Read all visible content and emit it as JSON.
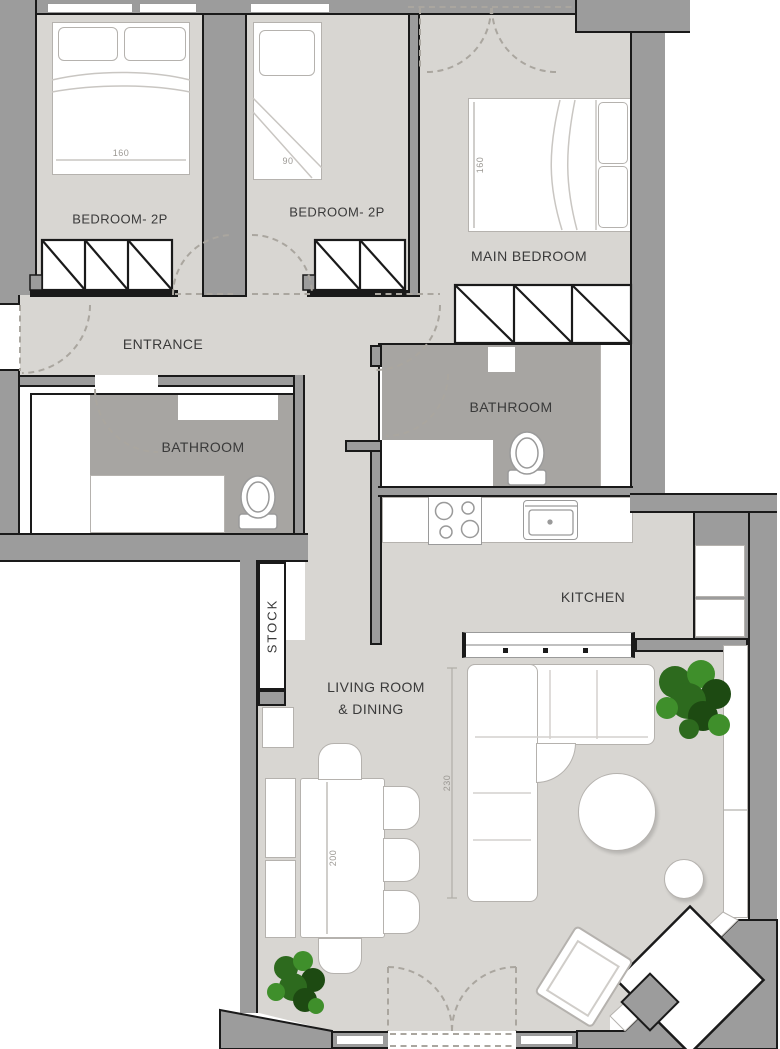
{
  "title": "Apartment floor plan",
  "rooms": {
    "bedroom1": {
      "label": "BEDROOM- 2P",
      "bed_dim": "160"
    },
    "bedroom2": {
      "label": "BEDROOM- 2P",
      "bed_dim": "90"
    },
    "main_bedroom": {
      "label": "MAIN BEDROOM",
      "bed_dim": "160"
    },
    "entrance": {
      "label": "ENTRANCE"
    },
    "bathroom_left": {
      "label": "BATHROOM"
    },
    "bathroom_right": {
      "label": "BATHROOM"
    },
    "kitchen": {
      "label": "KITCHEN"
    },
    "living": {
      "label_line1": "LIVING ROOM",
      "label_line2": "& DINING",
      "sofa_dim": "230",
      "table_dim": "200"
    },
    "stock": {
      "label": "STOCK"
    }
  },
  "colors": {
    "wall": "#9c9c9c",
    "wall_outline": "#1a1a1a",
    "floor": "#d8d6d2",
    "bathroom_floor": "#a7a5a2",
    "fixture_outline": "#b5b2ae",
    "dashed": "#aaa69f",
    "text": "#3a3a3a",
    "dim_text": "#9b9893",
    "plant_dark": "#1d4a12",
    "plant_mid": "#2d6a1e",
    "plant_light": "#3f8f2b"
  }
}
